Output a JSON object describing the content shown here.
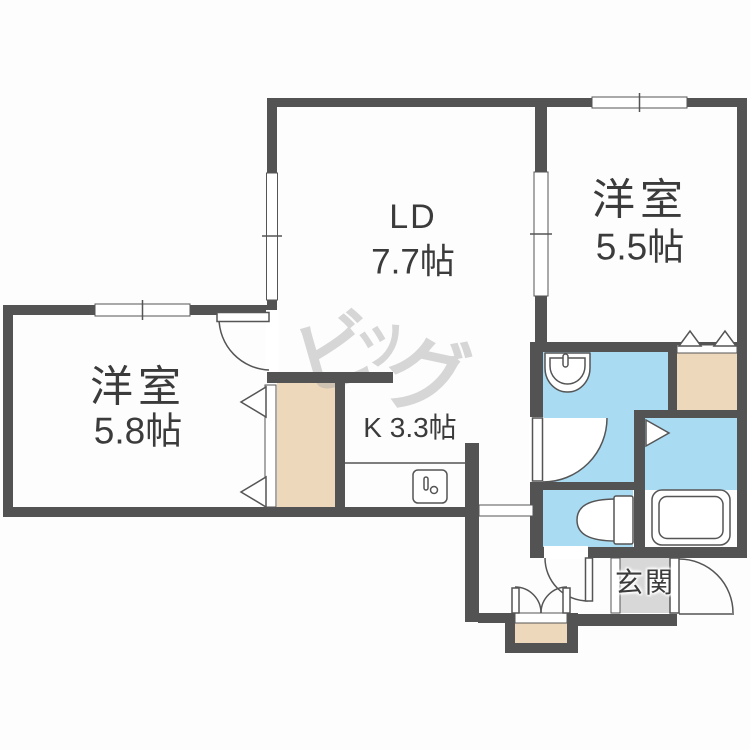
{
  "colors": {
    "wall": "#535353",
    "plumbing_blue": "#a9dbf3",
    "closet_tan": "#eed8bb",
    "entry_tile": "#d8d8d8",
    "line": "#555555",
    "text": "#3b3b3b",
    "watermark": "#a9a9a9",
    "background": "#fdfdfd"
  },
  "rooms": {
    "living_dining": {
      "name": "LD",
      "size": "7.7帖"
    },
    "bedroom_right": {
      "name": "洋室",
      "size": "5.5帖"
    },
    "bedroom_left": {
      "name": "洋室",
      "size": "5.8帖"
    },
    "kitchen": {
      "label": "K 3.3帖"
    },
    "entrance": {
      "label": "玄関"
    }
  },
  "watermark": {
    "char1": "ビ",
    "char2": "ッ",
    "char3": "グ"
  },
  "fixtures": [
    "kitchen-sink",
    "washbasin",
    "toilet",
    "bathtub",
    "window",
    "sliding-window",
    "hinged-door",
    "double-closet-door",
    "folding-closet-door",
    "entrance-door"
  ]
}
